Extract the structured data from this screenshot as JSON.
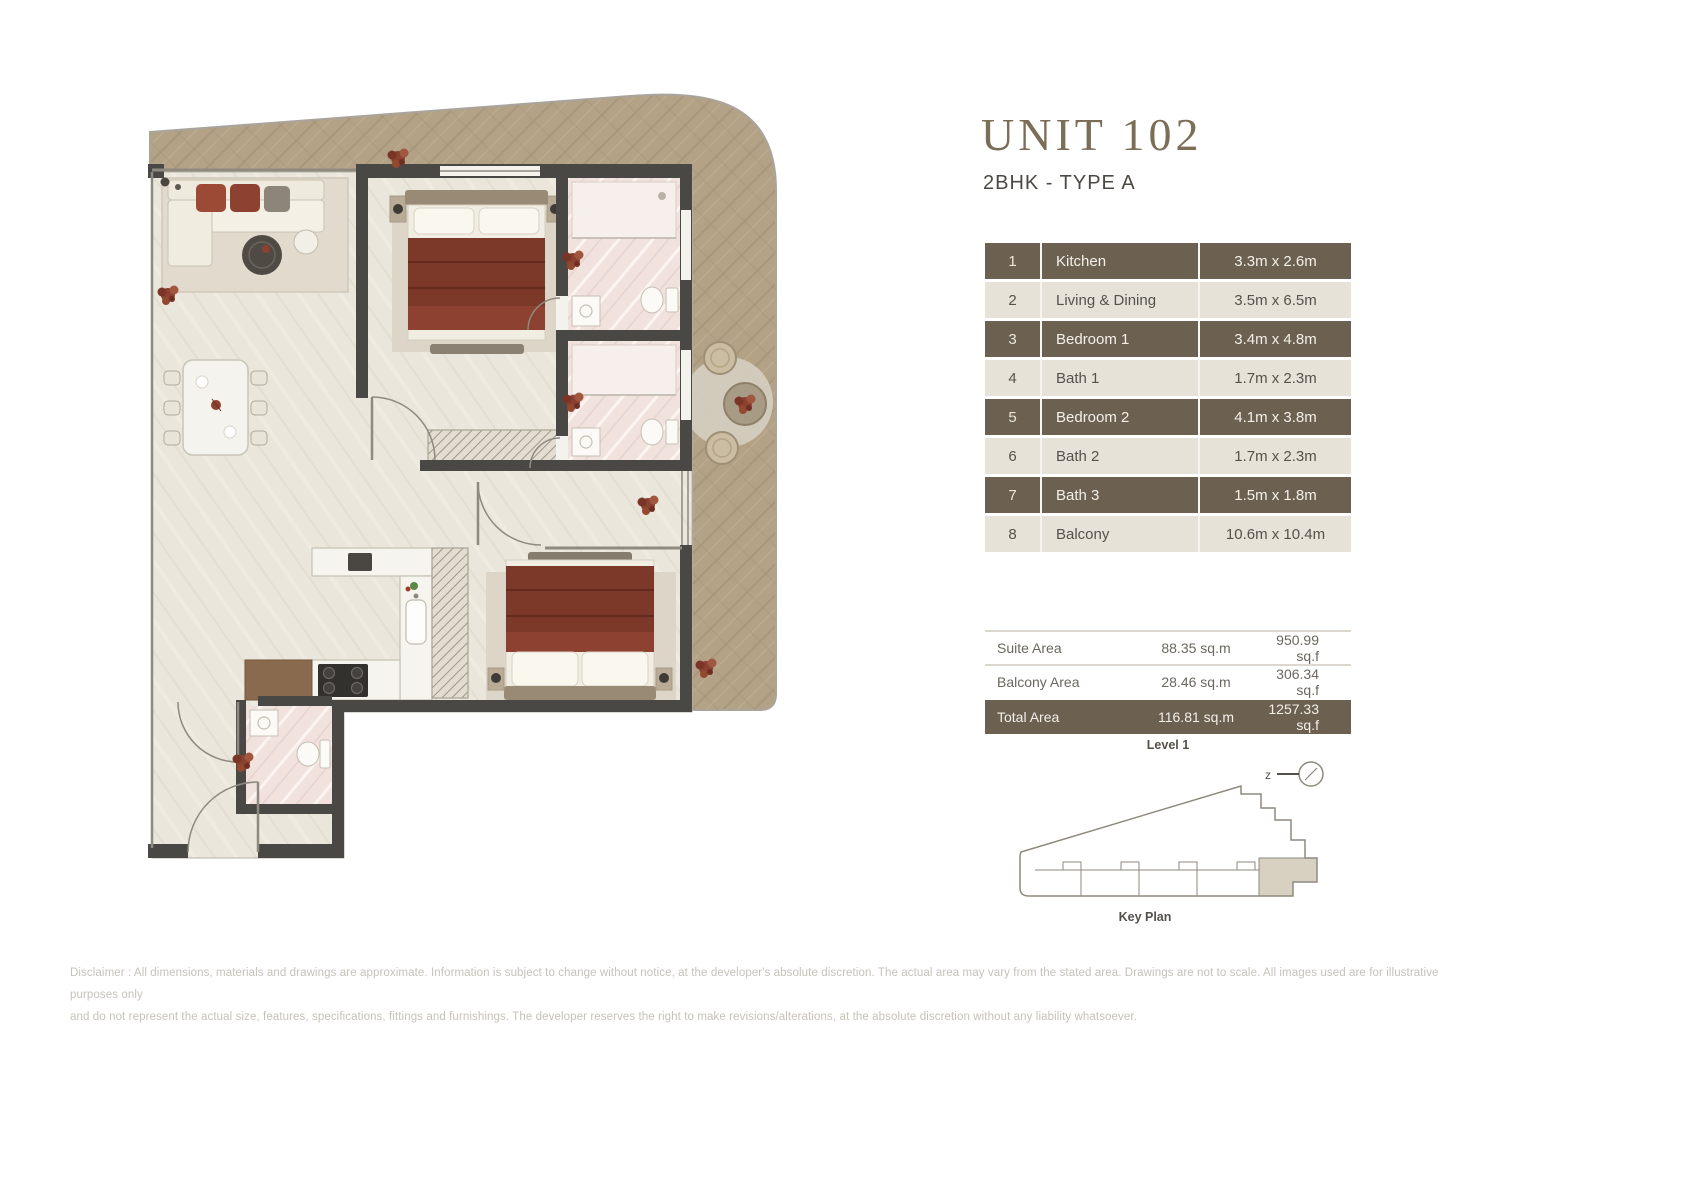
{
  "header": {
    "unit_title": "UNIT 102",
    "unit_subtitle": "2BHK - TYPE A"
  },
  "rooms": [
    {
      "no": "1",
      "name": "Kitchen",
      "dims": "3.3m x 2.6m"
    },
    {
      "no": "2",
      "name": "Living & Dining",
      "dims": "3.5m x 6.5m"
    },
    {
      "no": "3",
      "name": "Bedroom 1",
      "dims": "3.4m x 4.8m"
    },
    {
      "no": "4",
      "name": "Bath 1",
      "dims": "1.7m x 2.3m"
    },
    {
      "no": "5",
      "name": "Bedroom 2",
      "dims": "4.1m x 3.8m"
    },
    {
      "no": "6",
      "name": "Bath 2",
      "dims": "1.7m x 2.3m"
    },
    {
      "no": "7",
      "name": "Bath 3",
      "dims": "1.5m x 1.8m"
    },
    {
      "no": "8",
      "name": "Balcony",
      "dims": "10.6m x 10.4m"
    }
  ],
  "areas": [
    {
      "label": "Suite Area",
      "sqm": "88.35 sq.m",
      "sqf": "950.99 sq.f"
    },
    {
      "label": "Balcony Area",
      "sqm": "28.46 sq.m",
      "sqf": "306.34 sq.f"
    },
    {
      "label": "Total Area",
      "sqm": "116.81 sq.m",
      "sqf": "1257.33 sq.f"
    }
  ],
  "key_plan": {
    "level_label": "Level 1",
    "caption": "Key Plan",
    "compass_letter": "z"
  },
  "disclaimer": {
    "line1": "Disclaimer : All dimensions, materials and drawings are approximate. Information is subject to change without notice, at the developer's absolute discretion. The actual area may vary from the stated area. Drawings are not to scale. All images used are for illustrative purposes only",
    "line2": "and do not represent the actual size, features, specifications, fittings and furnishings. The developer reserves the right to make revisions/alterations, at the absolute discretion without any liability whatsoever."
  },
  "colors": {
    "accent_dark_brown": "#6c6051",
    "row_light_beige": "#e7e2d7",
    "title_brown": "#7c6d57",
    "wood_floor": "#b3a286",
    "interior_floor": "#eae6db",
    "wall_dark": "#4a4844",
    "bed_maroon": "#7c392a",
    "bath_pink": "#f1e2de",
    "keyplan_highlight": "#d8d1c2"
  }
}
